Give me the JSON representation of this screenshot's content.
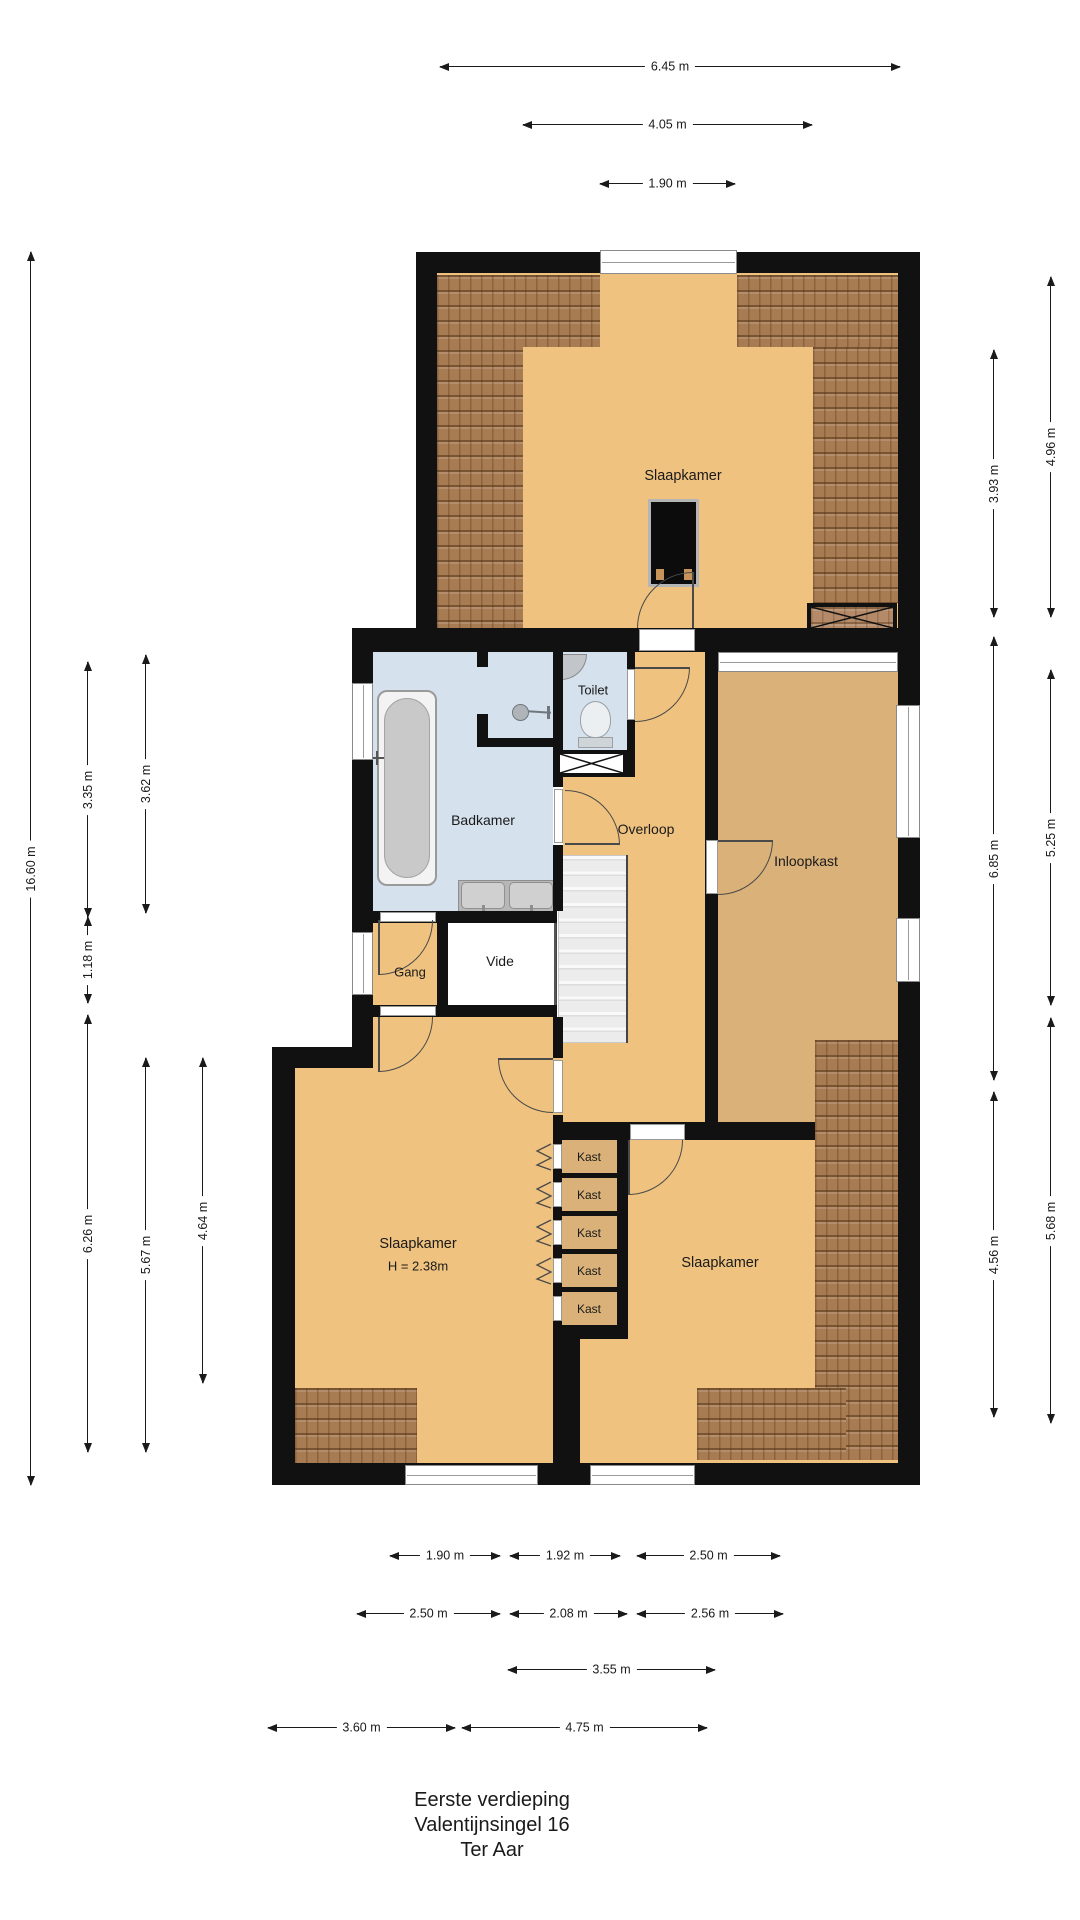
{
  "title": {
    "line1": "Eerste verdieping",
    "line2": "Valentijnsingel 16",
    "line3": "Ter Aar"
  },
  "rooms": {
    "bedroom_top": "Slaapkamer",
    "bathroom": "Badkamer",
    "toilet": "Toilet",
    "landing": "Overloop",
    "walk_in_closet": "Inloopkast",
    "hallway": "Gang",
    "void": "Vide",
    "bedroom_left": "Slaapkamer",
    "bedroom_left_height": "H = 2.38m",
    "bedroom_right": "Slaapkamer",
    "closets": [
      "Kast",
      "Kast",
      "Kast",
      "Kast",
      "Kast"
    ]
  },
  "dimensions": {
    "top": [
      "6.45 m",
      "4.05 m",
      "1.90 m"
    ],
    "left": [
      "16.60 m",
      "3.35 m",
      "3.62 m",
      "1.18 m",
      "6.26 m",
      "5.67 m",
      "4.64 m"
    ],
    "right": [
      "4.96 m",
      "3.93 m",
      "6.85 m",
      "5.25 m",
      "5.68 m",
      "4.56 m"
    ],
    "bottom_row1": [
      "1.90 m",
      "1.92 m",
      "2.50 m"
    ],
    "bottom_row2": [
      "2.50 m",
      "2.08 m",
      "2.56 m"
    ],
    "bottom_row3": [
      "3.55 m"
    ],
    "bottom_row4": [
      "3.60 m",
      "4.75 m"
    ]
  },
  "colors": {
    "wall": "#111111",
    "floor": "#f0c27f",
    "floor_dark": "#d9b179",
    "wet": "#d5e1ed",
    "hatch": "#a87c52"
  }
}
